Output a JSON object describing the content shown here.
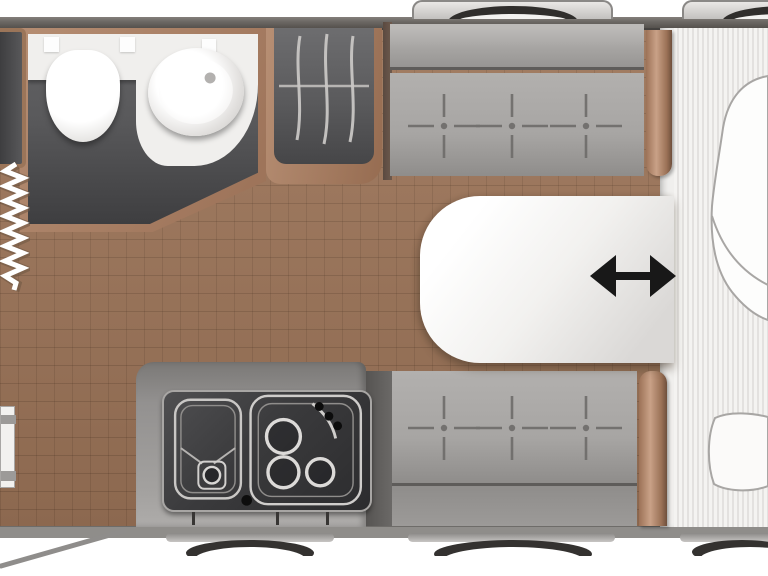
{
  "meta": {
    "title": "Caravan floor plan (top-down view)",
    "view": "plan"
  },
  "icons": {
    "slide_arrow": "double-headed-horizontal-arrow",
    "slide_arrow_glyph": "↔"
  },
  "fixtures": {
    "washroom": [
      "toilet",
      "washbasin",
      "vanity-counter"
    ],
    "wardrobe": "wardrobe-with-hanging-rail",
    "front_cabinet": "cabinet",
    "concertina_blind": "pleated-screen",
    "kitchen": [
      "sink-with-drainer",
      "three-burner-hob",
      "hob-knobs",
      "ignition-button"
    ],
    "dinette": [
      "front-bench",
      "rear-bench",
      "sliding-table"
    ],
    "bed": [
      "slatted-mattress",
      "duvet",
      "pillow"
    ],
    "entrance": "open-entrance-door-with-swing-line",
    "wheel_arches": [
      "top-left",
      "top-right",
      "bottom-left",
      "bottom-center",
      "bottom-right"
    ]
  },
  "colors": {
    "exterior": "#ffffff",
    "wall-top": "#6b6763",
    "wall-bottom": "#8f8d8a",
    "floor": "#9c7458",
    "wood-trim": "#a87f63",
    "room-floor": "#4a4a4c",
    "fixture": "#f0efed",
    "bench": "#a7a5a3",
    "bench-back": "#979593",
    "kitchen-recess": "#3a3a3c",
    "steel": "#cfcdcb",
    "table": "#f4f3f1",
    "bed": "#f0efed",
    "bed-stripe": "#e3e1df",
    "outline": "#a8a6a4",
    "tire": "#302e2c",
    "arrow": "#181818",
    "stitch": "#6e6c6a"
  }
}
